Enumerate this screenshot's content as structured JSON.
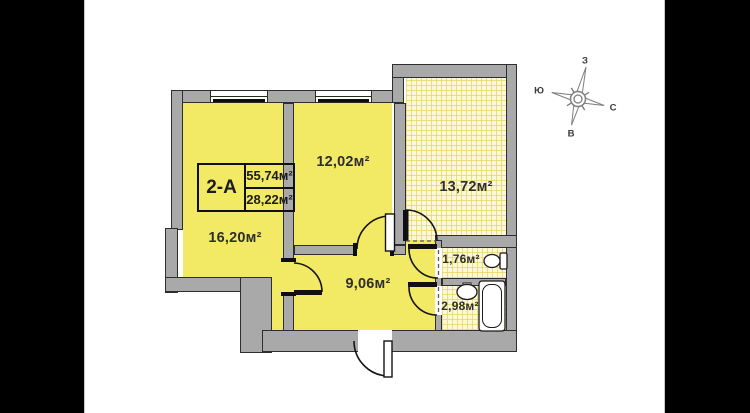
{
  "unit_card": {
    "unit_code": "2-А",
    "total_area": "55,74м²",
    "living_area": "28,22м²"
  },
  "rooms": {
    "living_room": "16,20м²",
    "bedroom": "12,02м²",
    "terrace": "13,72м²",
    "hallway": "9,06м²",
    "wc": "1,76м²",
    "bathroom": "2,98м²"
  },
  "compass": {
    "west": "З",
    "south": "Ю",
    "north": "С",
    "east": "В"
  },
  "colors": {
    "room_fill": "#f2e964",
    "tiled_fill": "#fcf8da",
    "wall_fill": "#a9a9a9",
    "letterbox": "#000000"
  }
}
